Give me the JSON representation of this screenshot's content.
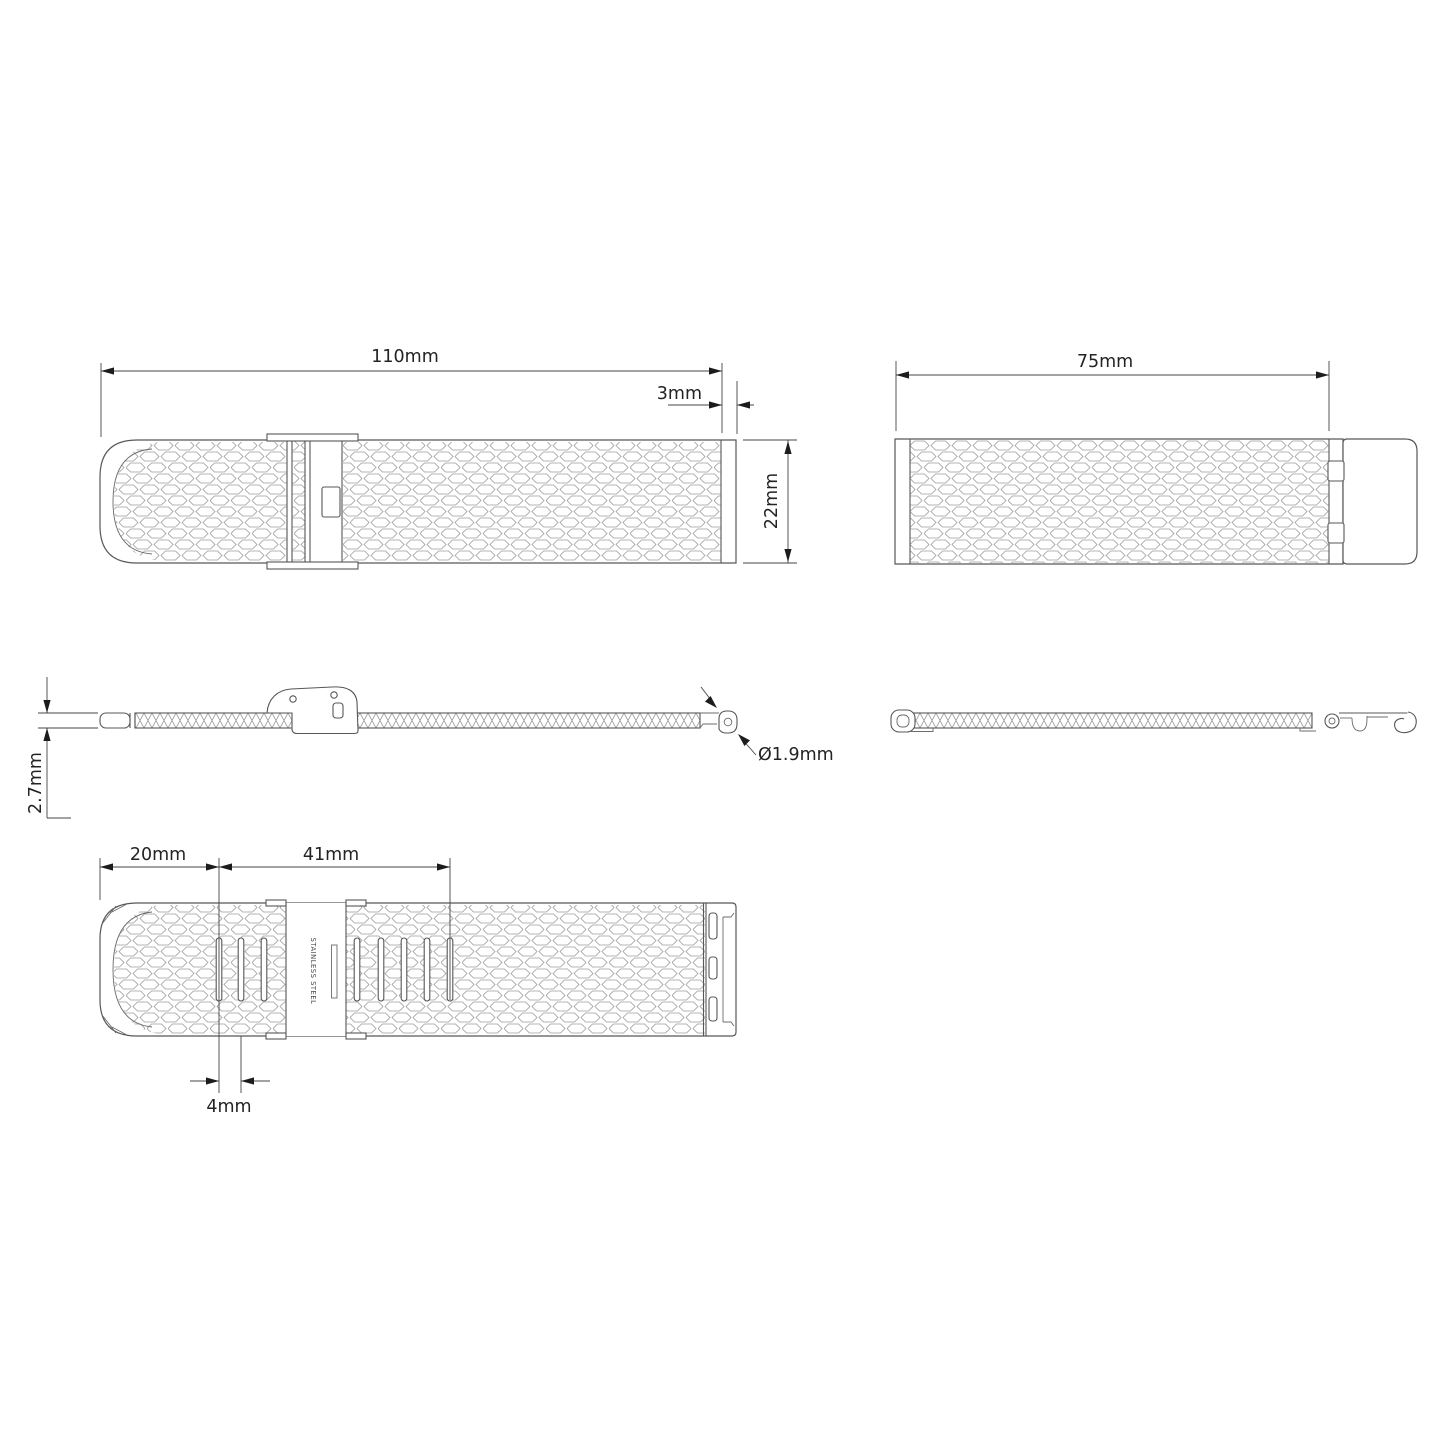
{
  "drawing_title": "watch-band-dimension-drawing",
  "colors": {
    "background": "#ffffff",
    "outline": "#575757",
    "mesh_pattern": "#9c9c9c",
    "dimension_line": "#454545",
    "dimension_text": "#232323",
    "arrowhead": "#1c1c1c"
  },
  "views": {
    "band_top_view": {
      "length": "110mm",
      "end_width": "3mm",
      "band_width": "22mm"
    },
    "band_top_view_short": {
      "length": "75mm"
    },
    "band_side_view": {
      "thickness": "2.7mm",
      "spring_bar_diameter": "Ø1.9mm"
    },
    "band_back_view": {
      "tail_length": "20mm",
      "adjustment_span": "41mm",
      "slot_pitch": "4mm",
      "clasp_engraving": "STAINLESS STEEL"
    }
  }
}
